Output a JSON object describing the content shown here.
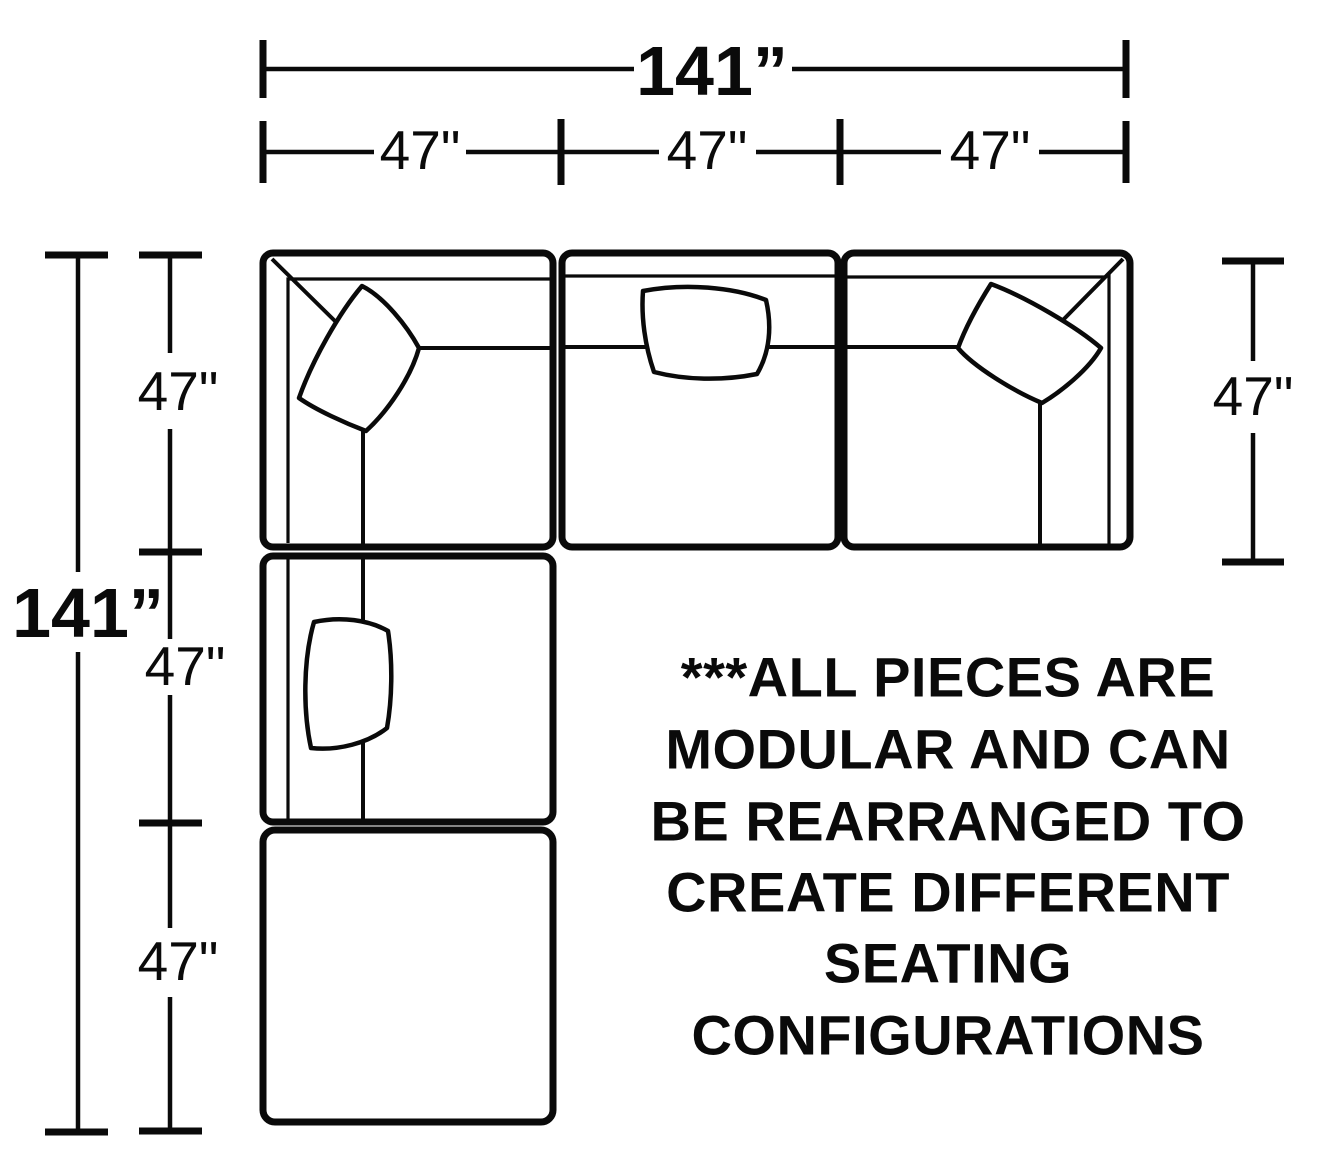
{
  "diagram": {
    "type": "sectional-sofa-floorplan-top-view",
    "ink_color": "#0a0a0a",
    "background_color": "#ffffff",
    "pieces": [
      "corner-sofa-top-left",
      "armless-sofa-top-center",
      "corner-sofa-top-right",
      "armless-sofa-left-middle",
      "ottoman-bottom-left"
    ],
    "dims": {
      "top_total": "141”",
      "top_seg_1": "47\"",
      "top_seg_2": "47\"",
      "top_seg_3": "47\"",
      "left_total": "141”",
      "left_seg_1": "47\"",
      "left_seg_2": "47\"",
      "left_seg_3": "47\"",
      "right_seg": "47\""
    },
    "note": {
      "full_text": "***ALL PIECES ARE MODULAR AND CAN BE REARRANGED TO CREATE DIFFERENT SEATING CONFIGURATIONS",
      "line1": "***ALL PIECES ARE",
      "line2": "MODULAR AND CAN",
      "line3": "BE REARRANGED TO",
      "line4": "CREATE DIFFERENT",
      "line5": "SEATING",
      "line6": "CONFIGURATIONS"
    }
  }
}
